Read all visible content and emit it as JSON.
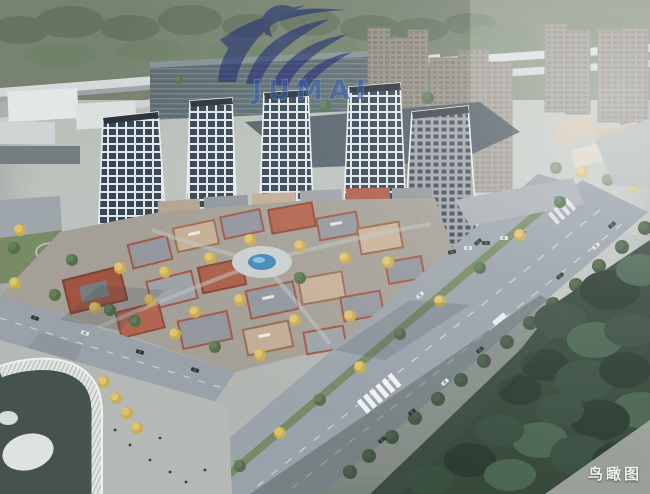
{
  "watermark": {
    "text": "JUMAI"
  },
  "caption": {
    "text": "鸟瞰图"
  },
  "palette": {
    "wm-blue": "#232f76",
    "wm-text": "#3a5cad",
    "wm-text-stroke": "#8ad2c6",
    "caption-color": "#eceeea",
    "pool-blue": "#3f85b5",
    "brick-red": "#a85a44",
    "forest-green": "#2f4233",
    "tree-yellow": "#d2b456",
    "road-gray": "#959ea7",
    "glass-dark": "#30404d",
    "mullion-white": "#e2e7ea"
  }
}
